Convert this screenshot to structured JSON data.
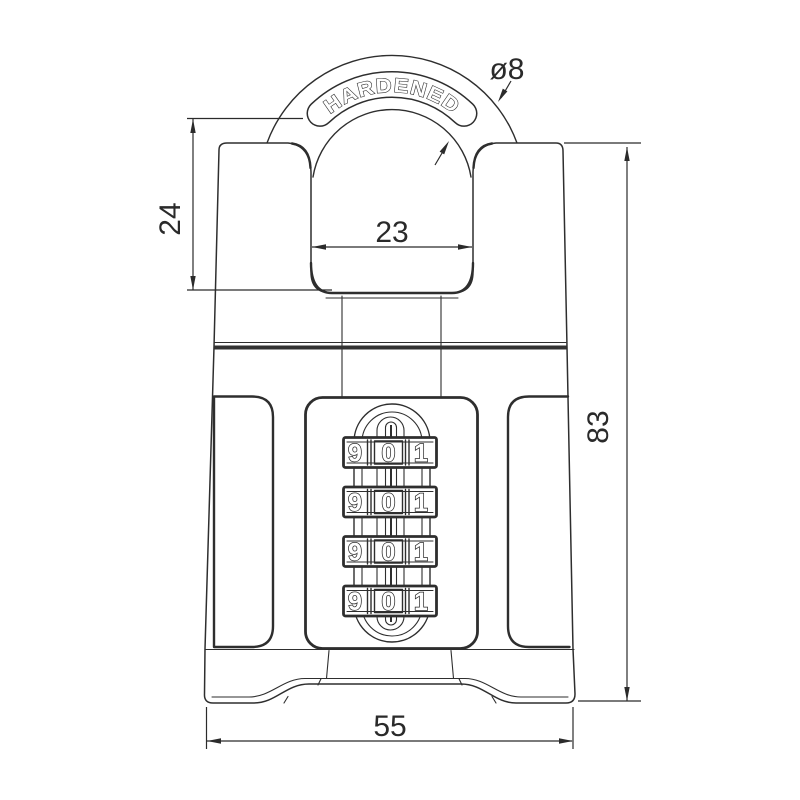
{
  "drawing": {
    "shackle_label": "HARDENED",
    "dimensions": {
      "shackle_diameter": "ø8",
      "shackle_height": "24",
      "shackle_inner_width": "23",
      "body_height": "83",
      "body_width": "55"
    },
    "dials": {
      "rows": [
        {
          "digits": [
            "9",
            "0",
            "1"
          ]
        },
        {
          "digits": [
            "9",
            "0",
            "1"
          ]
        },
        {
          "digits": [
            "9",
            "0",
            "1"
          ]
        },
        {
          "digits": [
            "9",
            "0",
            "1"
          ]
        }
      ]
    },
    "colors": {
      "line": "#2e2e2e",
      "dimension": "#2b2b2b",
      "background": "#ffffff"
    }
  }
}
